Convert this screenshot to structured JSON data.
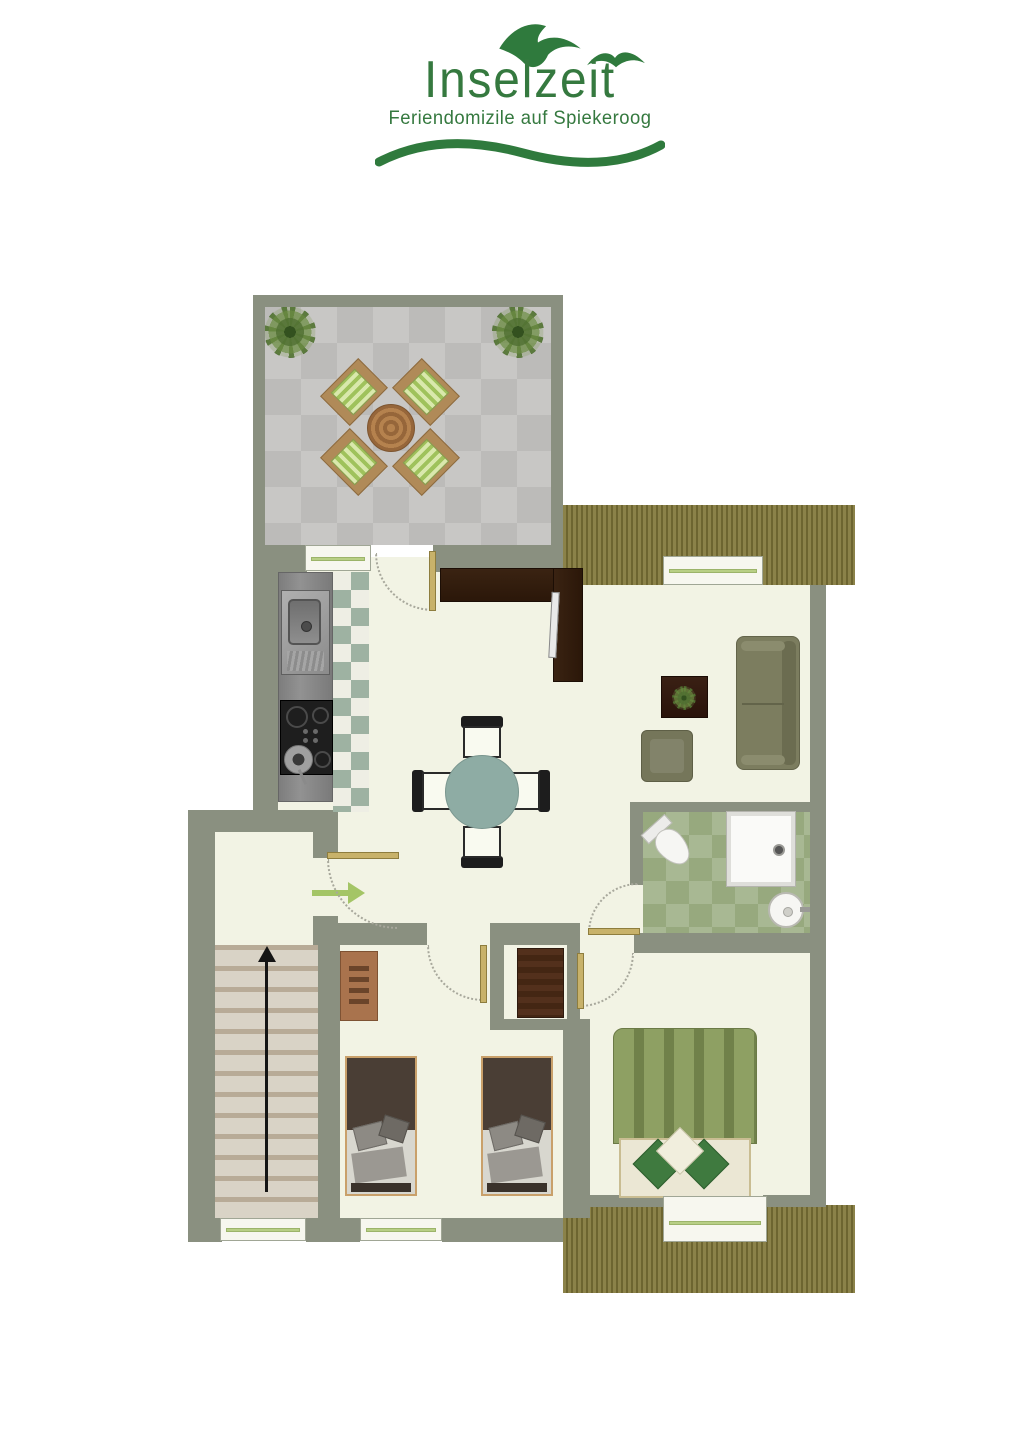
{
  "logo": {
    "title": "Inselzeit",
    "subtitle": "Feriendomizile auf Spiekeroog",
    "brand_color": "#35793f",
    "icons": [
      "seagull-icon",
      "seagull-icon",
      "wave-swoosh-icon"
    ]
  },
  "floor_plan": {
    "colors": {
      "wall": "#8a9080",
      "floor": "#f2f3e4",
      "terrace_tile_light": "#c8c7c5",
      "terrace_tile_dark": "#bcbbb9",
      "deck_wood": "#8b8249",
      "bathroom_tile": "#a8b893",
      "kitchen_tile_green": "#9eb2a2",
      "dining_table_top": "#8eaca4",
      "sofa_olive": "#7c7d5f",
      "master_duvet_green": "#8ea063",
      "kids_blanket_brown": "#4a3e35",
      "wood_light": "#a9734d",
      "wood_walnut": "#35200f",
      "door_leaf": "#c8b26a",
      "window_glass_line": "#b8cf85",
      "stair_tread": "#d9d3c6",
      "entrance_arrow": "#a4c566",
      "stairs_arrow": "#151515"
    },
    "areas": {
      "terrace": [
        "tiled-patio",
        "two-plants",
        "round-wood-table",
        "four-striped-chairs"
      ],
      "kitchen": [
        "steel-sink",
        "cooktop-with-pan",
        "diamond-tile-floor"
      ],
      "dining": [
        "round-table",
        "four-chairs"
      ],
      "living_room": [
        "sofa",
        "coffee-table-with-plant",
        "armchair",
        "tv-sideboard"
      ],
      "bathroom": [
        "toilet",
        "shower-tray",
        "washbasin",
        "green-tile-floor"
      ],
      "master_bedroom": [
        "double-bed-green-duvet",
        "decorative-pillows"
      ],
      "kids_room": [
        "two-single-beds",
        "dresser",
        "wardrobe"
      ],
      "stairwell": [
        "staircase",
        "up-arrow",
        "landing",
        "entrance-arrow"
      ],
      "balconies": [
        "upper-deck",
        "lower-deck"
      ]
    }
  }
}
